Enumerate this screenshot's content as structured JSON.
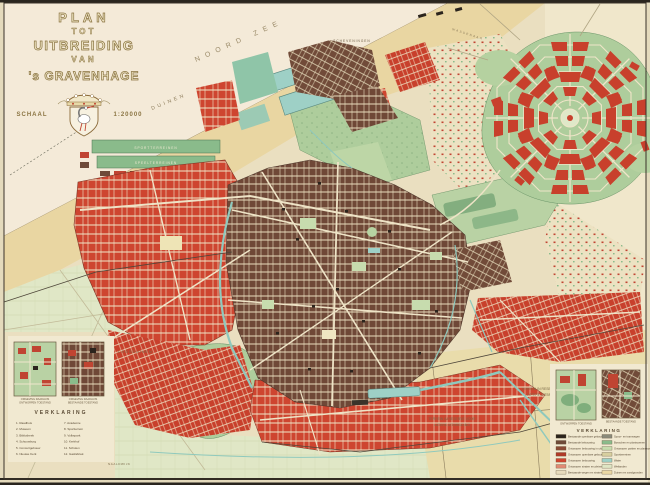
{
  "title_block": {
    "plan": "PLAN",
    "tot": "TOT",
    "uitbreiding": "UITBREIDING",
    "van": "VAN",
    "city": "'s GRAVENHAGE",
    "schaal": "SCHAAL",
    "scale": "1:20000"
  },
  "labels": {
    "sea": "NOORD ZEE",
    "dunes": "DUINEN",
    "scheveningen": "SCHEVENINGEN",
    "loosduinen": "LOOSDUINEN",
    "naaldwijk": "NAALDWIJK",
    "wassenaar": "WASSENAAR",
    "delft": "DELFT",
    "sport1": "SPORTTERREINEN",
    "sport2": "SPEELTERREINEN",
    "reserve1a": "TERREIN IN RESERVE VOOR",
    "reserve1b": "LATERE UITBREIDING",
    "reserve2a": "TERREIN IN RESERVE VOOR",
    "reserve2b": "LATERE UITBREIDING"
  },
  "legend_left": {
    "heading": "VERKLARING",
    "inset1_caption1": "OMGEVING RAADHUIS",
    "inset1_caption2": "ONTWORPEN TOESTAND",
    "inset2_caption1": "OMGEVING RAADHUIS",
    "inset2_caption2": "BESTAANDE TOESTAND",
    "col1": [
      "1. Raadhuis",
      "2. Museum",
      "3. Bibliotheek",
      "4. Schouwburg",
      "5. Concertgebouw",
      "6. Nieuwe Kerk"
    ],
    "col2": [
      "7. Academie",
      "8. Sportterrein",
      "9. Volkspark",
      "10. Kerkhof",
      "11. Scholen",
      "12. Gasfabriek"
    ]
  },
  "legend_right": {
    "heading": "VERKLARING",
    "inset1_caption": "ONTWORPEN TOESTAND",
    "inset2_caption": "BESTAANDE TOESTAND",
    "col1": [
      {
        "color": "#2b241d",
        "label": "Bestaande openbare gebouwen"
      },
      {
        "color": "#6e4a38",
        "label": "Bestaande bebouwing"
      },
      {
        "color": "#8a4a34",
        "label": "Ontworpen bebouwing in uitvoering"
      },
      {
        "color": "#b03a28",
        "label": "Ontworpen openbare gebouwen"
      },
      {
        "color": "#cf4530",
        "label": "Ontworpen bebouwing"
      },
      {
        "color": "#e08a74",
        "label": "Ontworpen straten en pleinen"
      },
      {
        "color": "#e7dbbd",
        "label": "Bestaande wegen en straten"
      }
    ],
    "col2": [
      {
        "color": "#8a8a7a",
        "label": "Spoor- en tramwegen"
      },
      {
        "color": "#8abb8b",
        "label": "Bosschen en plantsoenen"
      },
      {
        "color": "#c7dcae",
        "label": "Ontworpen parken en plantsoenen"
      },
      {
        "color": "#d8cfa0",
        "label": "Sportterreinen"
      },
      {
        "color": "#9ed0c6",
        "label": "Water"
      },
      {
        "color": "#dfe6c5",
        "label": "Weilanden"
      },
      {
        "color": "#e9d7a4",
        "label": "Duinen en zandgronden"
      }
    ]
  },
  "colors": {
    "paper": "#eadfc0",
    "sea": "#f4ead8",
    "dunes": "#e9d6a2",
    "polder_green": "#dfe6c5",
    "park_green": "#aecd9c",
    "sports_green": "#8abb8b",
    "dark_park_green": "#7fae7c",
    "new_blocks_red": "#ce4530",
    "existing_blocks_brown": "#6f4837",
    "public_building_black": "#2b241d",
    "water_teal": "#9ed0c6",
    "reserve_tan": "#e9dcab",
    "frame_dark": "#2a261f",
    "street_cream": "#eee3c6"
  }
}
